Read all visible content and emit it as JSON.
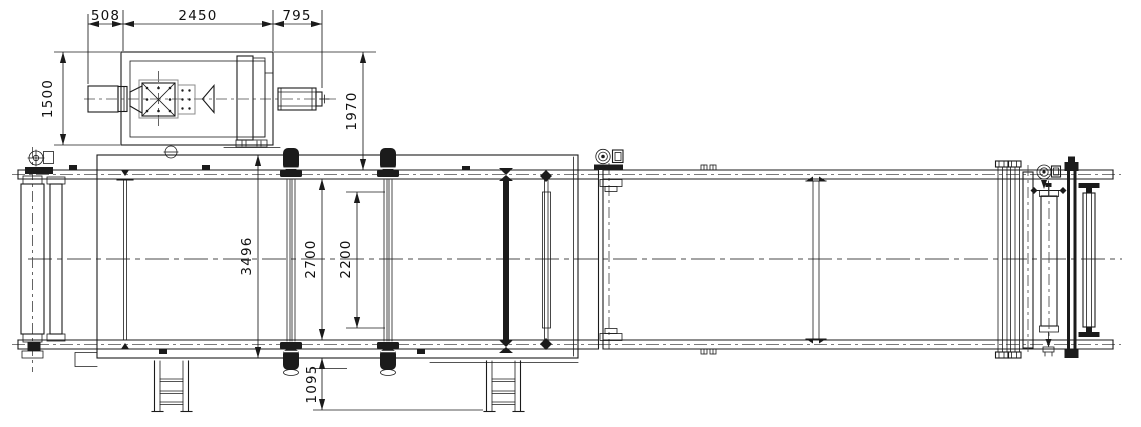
{
  "sheet": {
    "description": "Plan-view engineering drawing of a belt conveyor line with top-mounted drive unit",
    "background": "#ffffff",
    "ink": "#1b1b1b",
    "secondary_ink": "#8b8b8b",
    "units": "mm"
  },
  "dims": {
    "d508": "508",
    "d2450": "2450",
    "d795": "795",
    "d1500": "1500",
    "d1970": "1970",
    "d3496": "3496",
    "d2700": "2700",
    "d2200": "2200",
    "d1095": "1095"
  }
}
